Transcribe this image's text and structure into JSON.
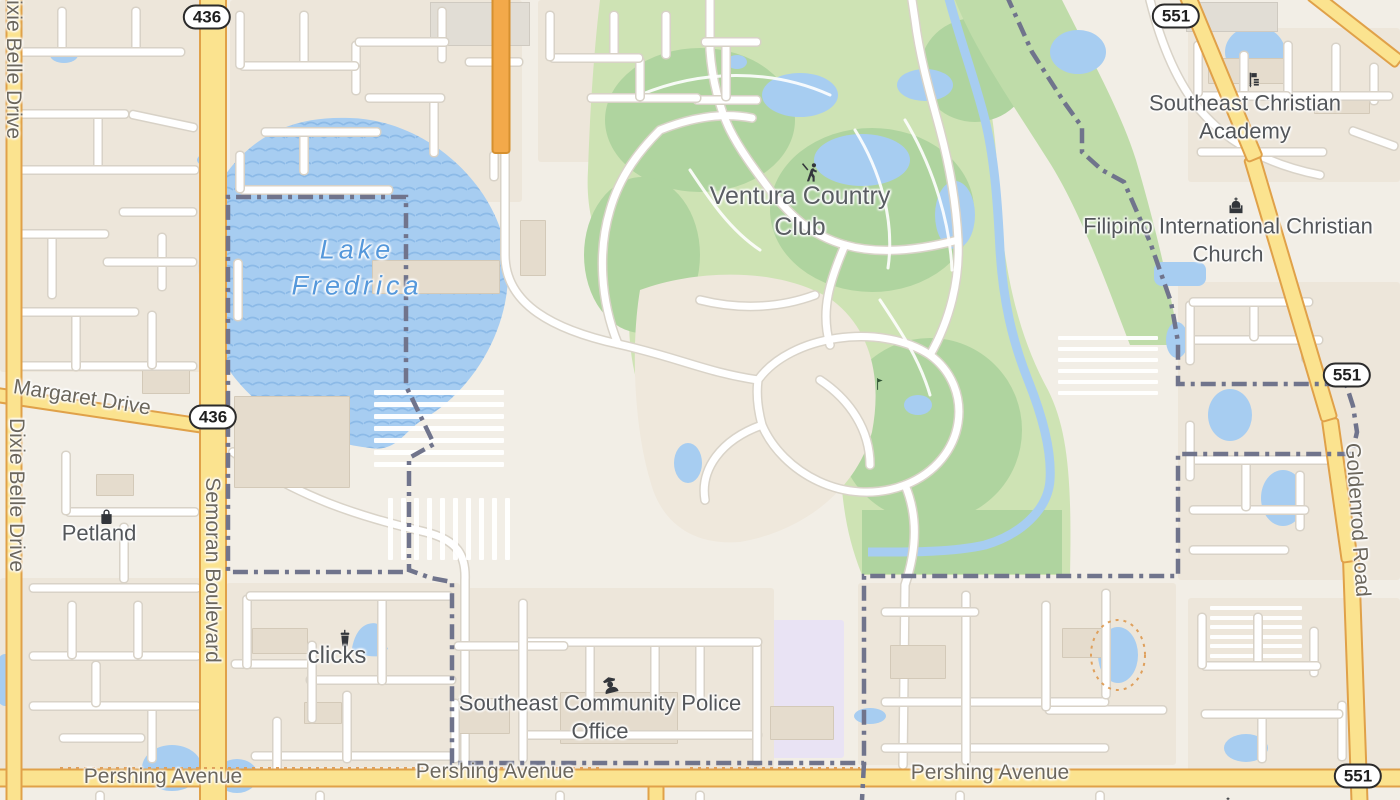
{
  "map": {
    "pois": {
      "ventura": {
        "label": "Ventura Country Club"
      },
      "academy": {
        "label": "Southeast Christian Academy"
      },
      "church": {
        "label": "Filipino International Christian Church"
      },
      "petland": {
        "label": "Petland"
      },
      "clicks": {
        "label": "clicks"
      },
      "police": {
        "label": "Southeast Community Police Office"
      }
    },
    "water": {
      "lake": "Lake Fredrica"
    },
    "roads": {
      "dixie_belle": "Dixie Belle Drive",
      "semoran": "Semoran Boulevard",
      "margaret": "Margaret Drive",
      "pershing": "Pershing Avenue",
      "goldenrod": "Goldenrod Road"
    },
    "route_shields": {
      "sr436": "436",
      "sr551": "551"
    },
    "colors": {
      "land": "#F2EEE6",
      "residential": "#EDE6DA",
      "water": "#A7CDF1",
      "golf_light": "#CEE3B4",
      "golf_dark": "#AFD49F",
      "road_primary_fill": "#FBE38F",
      "road_primary_casing": "#E0A149",
      "road_secondary_fill": "#F3A94A",
      "boundary": "#70748C",
      "school_zone": "#E9E3F4"
    }
  }
}
